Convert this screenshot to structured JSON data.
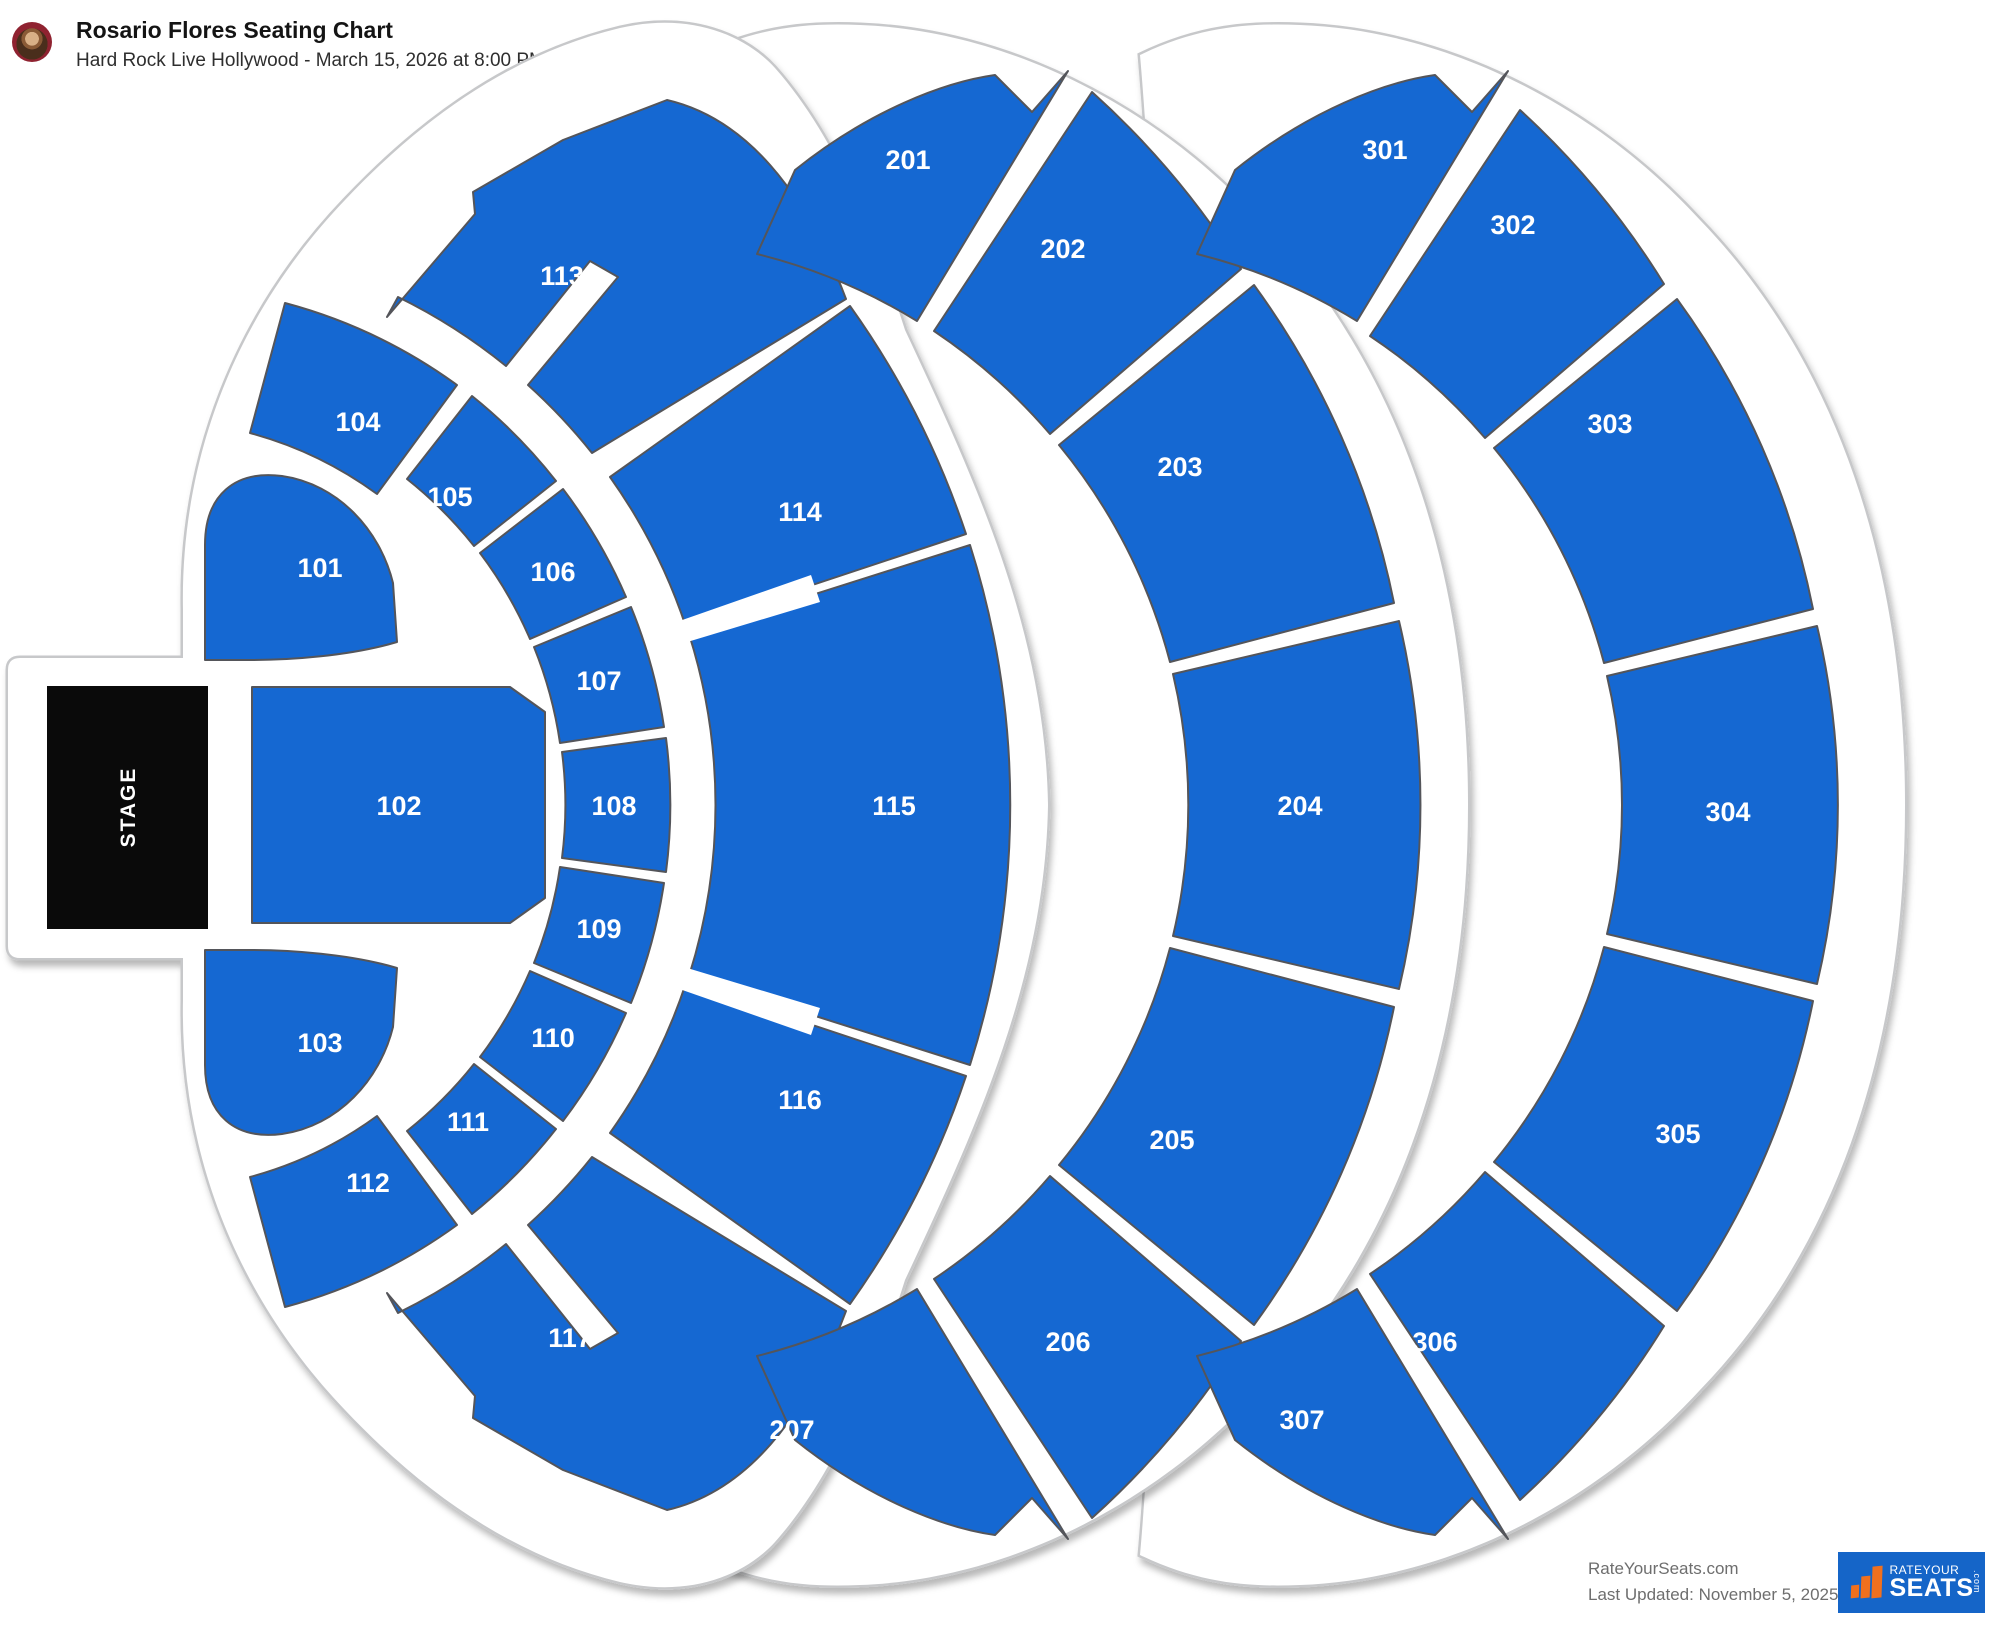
{
  "header": {
    "title": "Rosario Flores Seating Chart",
    "subtitle": "Hard Rock Live Hollywood - March 15, 2026 at 8:00 PM"
  },
  "stage": {
    "label": "STAGE"
  },
  "sections": [
    {
      "id": "101",
      "label": "101",
      "x": 320,
      "y": 568
    },
    {
      "id": "102",
      "label": "102",
      "x": 399,
      "y": 806
    },
    {
      "id": "103",
      "label": "103",
      "x": 320,
      "y": 1043
    },
    {
      "id": "104",
      "label": "104",
      "x": 358,
      "y": 422
    },
    {
      "id": "105",
      "label": "105",
      "x": 450,
      "y": 497
    },
    {
      "id": "106",
      "label": "106",
      "x": 553,
      "y": 572
    },
    {
      "id": "107",
      "label": "107",
      "x": 599,
      "y": 681
    },
    {
      "id": "108",
      "label": "108",
      "x": 614,
      "y": 806
    },
    {
      "id": "109",
      "label": "109",
      "x": 599,
      "y": 929
    },
    {
      "id": "110",
      "label": "110",
      "x": 553,
      "y": 1038
    },
    {
      "id": "111",
      "label": "111",
      "x": 468,
      "y": 1122
    },
    {
      "id": "112",
      "label": "112",
      "x": 368,
      "y": 1183
    },
    {
      "id": "113",
      "label": "113",
      "x": 562,
      "y": 276
    },
    {
      "id": "114",
      "label": "114",
      "x": 800,
      "y": 512
    },
    {
      "id": "115",
      "label": "115",
      "x": 894,
      "y": 806
    },
    {
      "id": "116",
      "label": "116",
      "x": 800,
      "y": 1100
    },
    {
      "id": "117",
      "label": "117",
      "x": 570,
      "y": 1338
    },
    {
      "id": "201",
      "label": "201",
      "x": 908,
      "y": 160
    },
    {
      "id": "202",
      "label": "202",
      "x": 1063,
      "y": 249
    },
    {
      "id": "203",
      "label": "203",
      "x": 1180,
      "y": 467
    },
    {
      "id": "204",
      "label": "204",
      "x": 1300,
      "y": 806
    },
    {
      "id": "205",
      "label": "205",
      "x": 1172,
      "y": 1140
    },
    {
      "id": "206",
      "label": "206",
      "x": 1068,
      "y": 1342
    },
    {
      "id": "207",
      "label": "207",
      "x": 792,
      "y": 1430
    },
    {
      "id": "301",
      "label": "301",
      "x": 1385,
      "y": 150
    },
    {
      "id": "302",
      "label": "302",
      "x": 1513,
      "y": 225
    },
    {
      "id": "303",
      "label": "303",
      "x": 1610,
      "y": 424
    },
    {
      "id": "304",
      "label": "304",
      "x": 1728,
      "y": 812
    },
    {
      "id": "305",
      "label": "305",
      "x": 1678,
      "y": 1134
    },
    {
      "id": "306",
      "label": "306",
      "x": 1435,
      "y": 1342
    },
    {
      "id": "307",
      "label": "307",
      "x": 1302,
      "y": 1420
    }
  ],
  "footer": {
    "site": "RateYourSeats.com",
    "updated": "Last Updated: November 5, 2025",
    "logo_line1": "RATEYOUR",
    "logo_line2": "SEATS",
    "logo_suffix": ".com"
  }
}
